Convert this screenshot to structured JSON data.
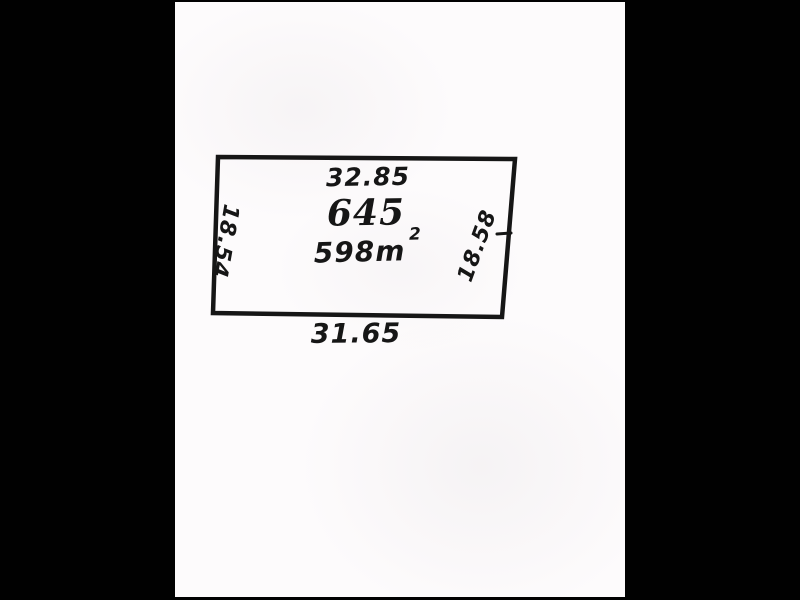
{
  "plan": {
    "lot_number": "645",
    "area_value": "598m",
    "area_superscript": "2",
    "dimensions": {
      "top": "32.85",
      "bottom": "31.65",
      "left": "18.54",
      "right": "18.58"
    },
    "colors": {
      "background": "#010101",
      "paper": "#fdfbfc",
      "ink": "#161616"
    }
  }
}
